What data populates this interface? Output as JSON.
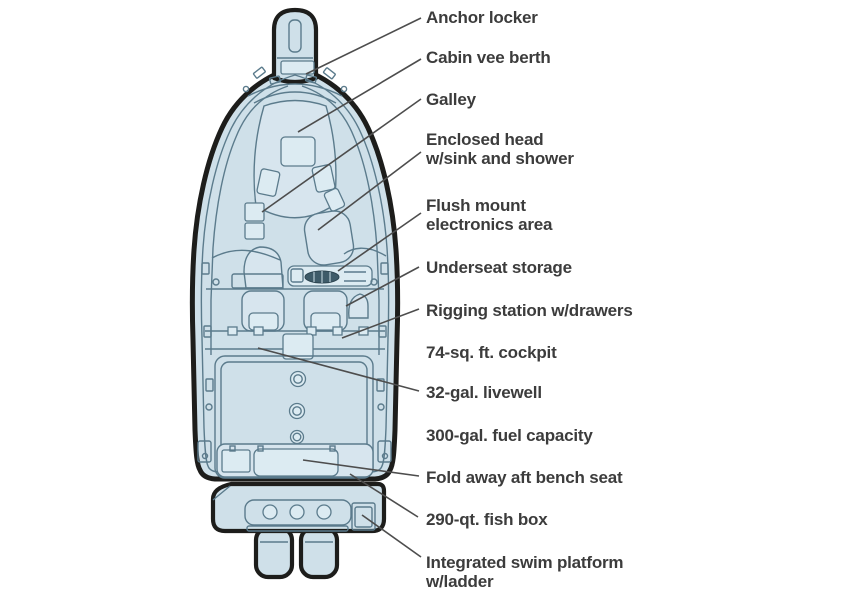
{
  "figure": {
    "title": "Boat deck plan (overhead view)",
    "colors": {
      "background": "#ffffff",
      "hull_fill": "#cfe0e9",
      "structure_fill": "#d7e5ee",
      "interior_line": "#5b7b8c",
      "hull_outline": "#1d1d1b",
      "dashboard_dark": "#3e5b69",
      "label_text": "#3c3c3c",
      "leader_line": "#4d4d4d"
    },
    "labels": [
      {
        "id": "anchor-locker",
        "text": "Anchor locker"
      },
      {
        "id": "cabin-vee-berth",
        "text": "Cabin vee berth"
      },
      {
        "id": "galley",
        "text": "Galley"
      },
      {
        "id": "enclosed-head",
        "text": "Enclosed head\nw/sink and shower"
      },
      {
        "id": "flush-mount-electronics",
        "text": "Flush mount\nelectronics area"
      },
      {
        "id": "underseat-storage",
        "text": "Underseat storage"
      },
      {
        "id": "rigging-station",
        "text": "Rigging station w/drawers"
      },
      {
        "id": "cockpit",
        "text": "74-sq. ft. cockpit"
      },
      {
        "id": "livewell",
        "text": "32-gal. livewell"
      },
      {
        "id": "fuel-capacity",
        "text": "300-gal. fuel capacity"
      },
      {
        "id": "aft-bench-seat",
        "text": "Fold away aft bench seat"
      },
      {
        "id": "fish-box",
        "text": "290-qt. fish box"
      },
      {
        "id": "swim-platform",
        "text": "Integrated swim platform\nw/ladder"
      }
    ]
  }
}
